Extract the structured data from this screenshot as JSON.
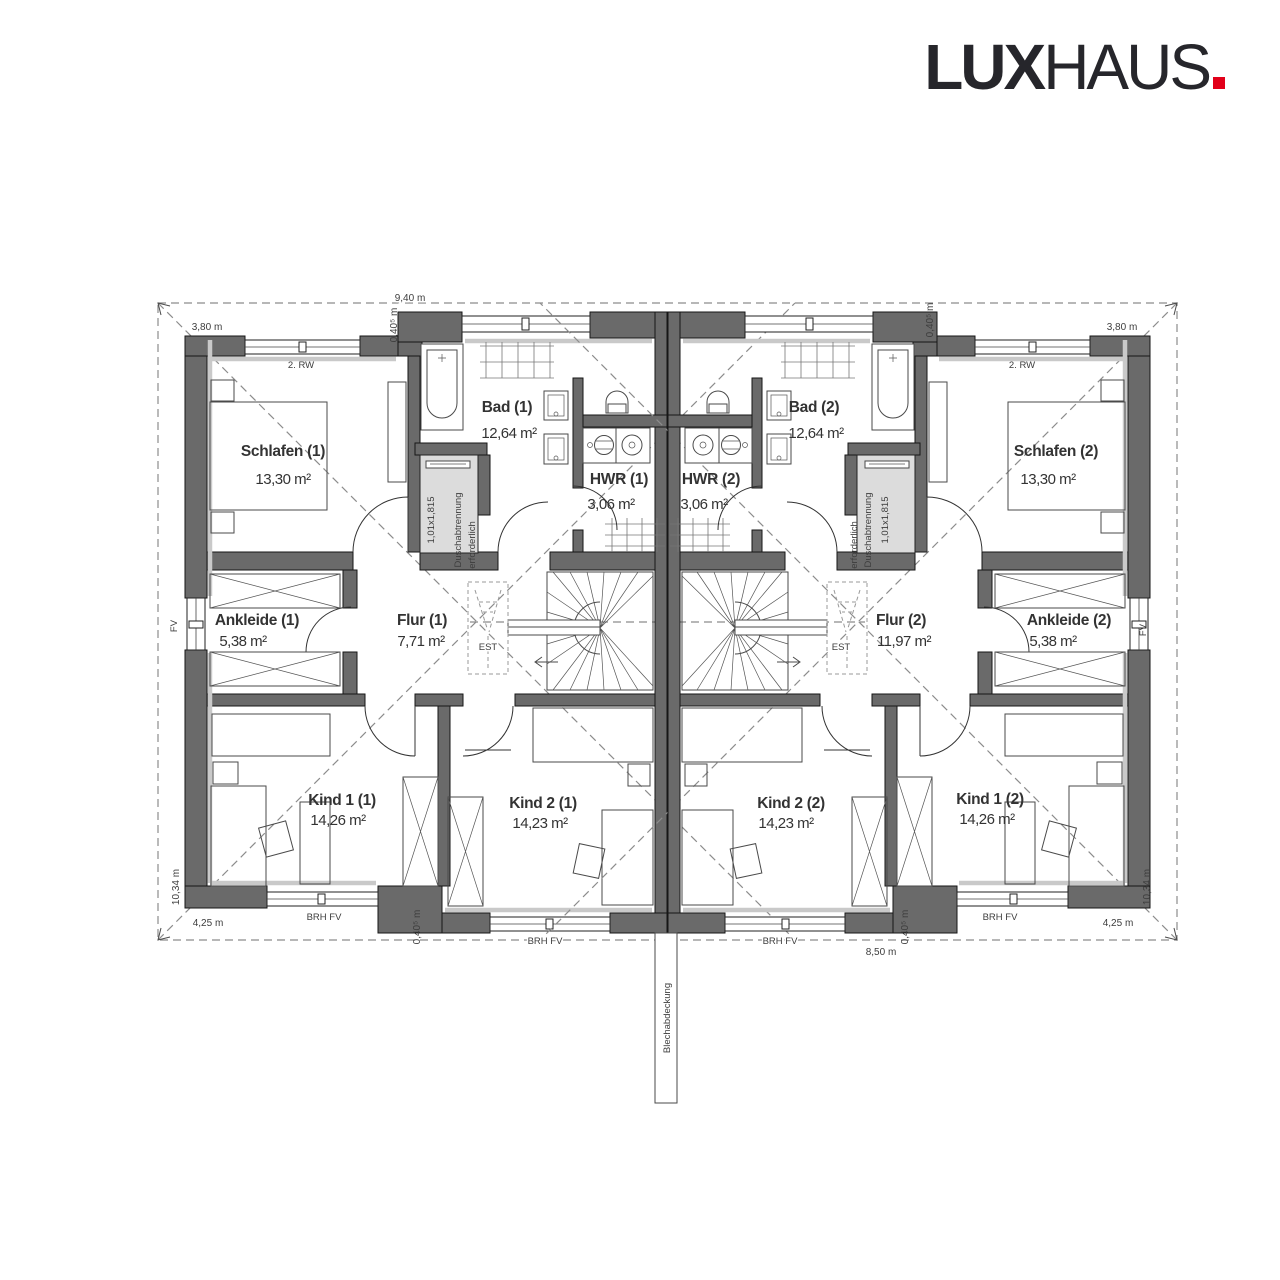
{
  "logo": {
    "part_bold": "LUX",
    "part_light": "HAUS",
    "dot": ".",
    "dot_color": "#e2001a"
  },
  "rooms": [
    {
      "name": "Schlafen (1)",
      "area": "13,30 m²"
    },
    {
      "name": "Bad (1)",
      "area": "12,64 m²"
    },
    {
      "name": "HWR (1)",
      "area": "3,06 m²"
    },
    {
      "name": "HWR (2)",
      "area": "3,06 m²"
    },
    {
      "name": "Bad (2)",
      "area": "12,64 m²"
    },
    {
      "name": "Schlafen (2)",
      "area": "13,30 m²"
    },
    {
      "name": "Ankleide (1)",
      "area": "5,38 m²"
    },
    {
      "name": "Flur (1)",
      "area": "7,71 m²"
    },
    {
      "name": "Flur (2)",
      "area": "11,97 m²"
    },
    {
      "name": "Ankleide (2)",
      "area": "5,38 m²"
    },
    {
      "name": "Kind 1 (1)",
      "area": "14,26 m²"
    },
    {
      "name": "Kind 2 (1)",
      "area": "14,23 m²"
    },
    {
      "name": "Kind 2 (2)",
      "area": "14,23 m²"
    },
    {
      "name": "Kind 1 (2)",
      "area": "14,26 m²"
    }
  ],
  "dimensions": {
    "total_width_top": "9,40 m",
    "offset": "0,40⁵ m",
    "wing_width": "3,80 m",
    "side_depth": "10,34 m",
    "wing_bottom_width": "4,25 m",
    "center_bottom_width": "8,50 m"
  },
  "annotations": {
    "window_note_top": "2. RW",
    "window_note_side": "FV",
    "window_note_bottom": "BRH FV",
    "attic_access": "EST",
    "shower_size": "1,01x1,815",
    "shower_note_line1": "Duschabtrennung",
    "shower_note_line2": "erforderlich",
    "roof_edge_note": "Blechabdeckung"
  }
}
